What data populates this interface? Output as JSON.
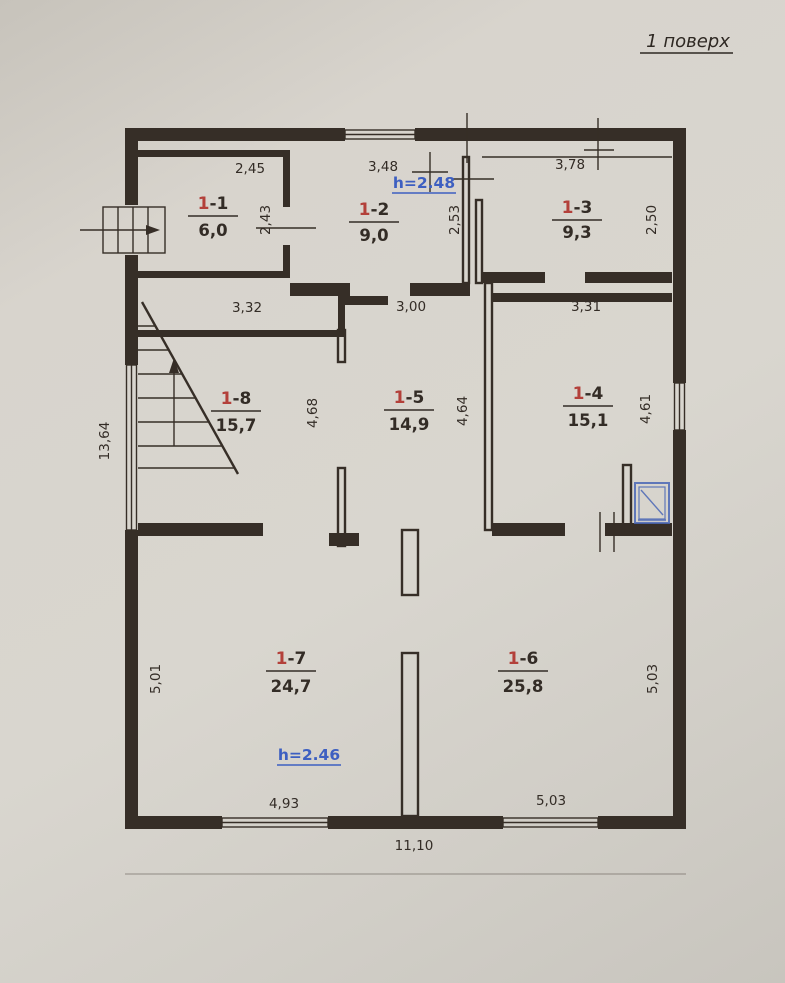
{
  "title": "1 поверх",
  "colors": {
    "paper": "#d5d1c9",
    "wall_line": "#362e27",
    "room_number_accent": "#b3403a",
    "height_note_blue": "#3d5fc1"
  },
  "rooms": {
    "r11": {
      "prefix": "1",
      "suffix": "-1",
      "area": "6,0",
      "dim_width": "2,45",
      "dim_height": "2,43"
    },
    "r12": {
      "prefix": "1",
      "suffix": "-2",
      "area": "9,0",
      "dim_width": "3,48",
      "dim_height": "2,53"
    },
    "r13": {
      "prefix": "1",
      "suffix": "-3",
      "area": "9,3",
      "dim_width": "3,78",
      "dim_height": "2,50"
    },
    "r18": {
      "prefix": "1",
      "suffix": "-8",
      "area": "15,7",
      "dim_width": "3,32",
      "dim_height": "4,68"
    },
    "r15": {
      "prefix": "1",
      "suffix": "-5",
      "area": "14,9",
      "dim_width": "3,00",
      "dim_height": "4,64"
    },
    "r14": {
      "prefix": "1",
      "suffix": "-4",
      "area": "15,1",
      "dim_width": "3,31",
      "dim_height": "4,61"
    },
    "r17": {
      "prefix": "1",
      "suffix": "-7",
      "area": "24,7",
      "dim_height": "5,01"
    },
    "r16": {
      "prefix": "1",
      "suffix": "-6",
      "area": "25,8",
      "dim_height": "5,03"
    }
  },
  "heights": {
    "upper": "h=2.48",
    "lower": "h=2.46"
  },
  "exterior_dims": {
    "left_total": "13,64",
    "bottom_total": "11,10",
    "bottom_window_left": "4,93",
    "bottom_window_right": "5,03"
  },
  "fixtures": {
    "stairs": "stairs-with-up-arrow",
    "entrance": "entry-steps-with-arrow",
    "shower": "shower-tray"
  }
}
